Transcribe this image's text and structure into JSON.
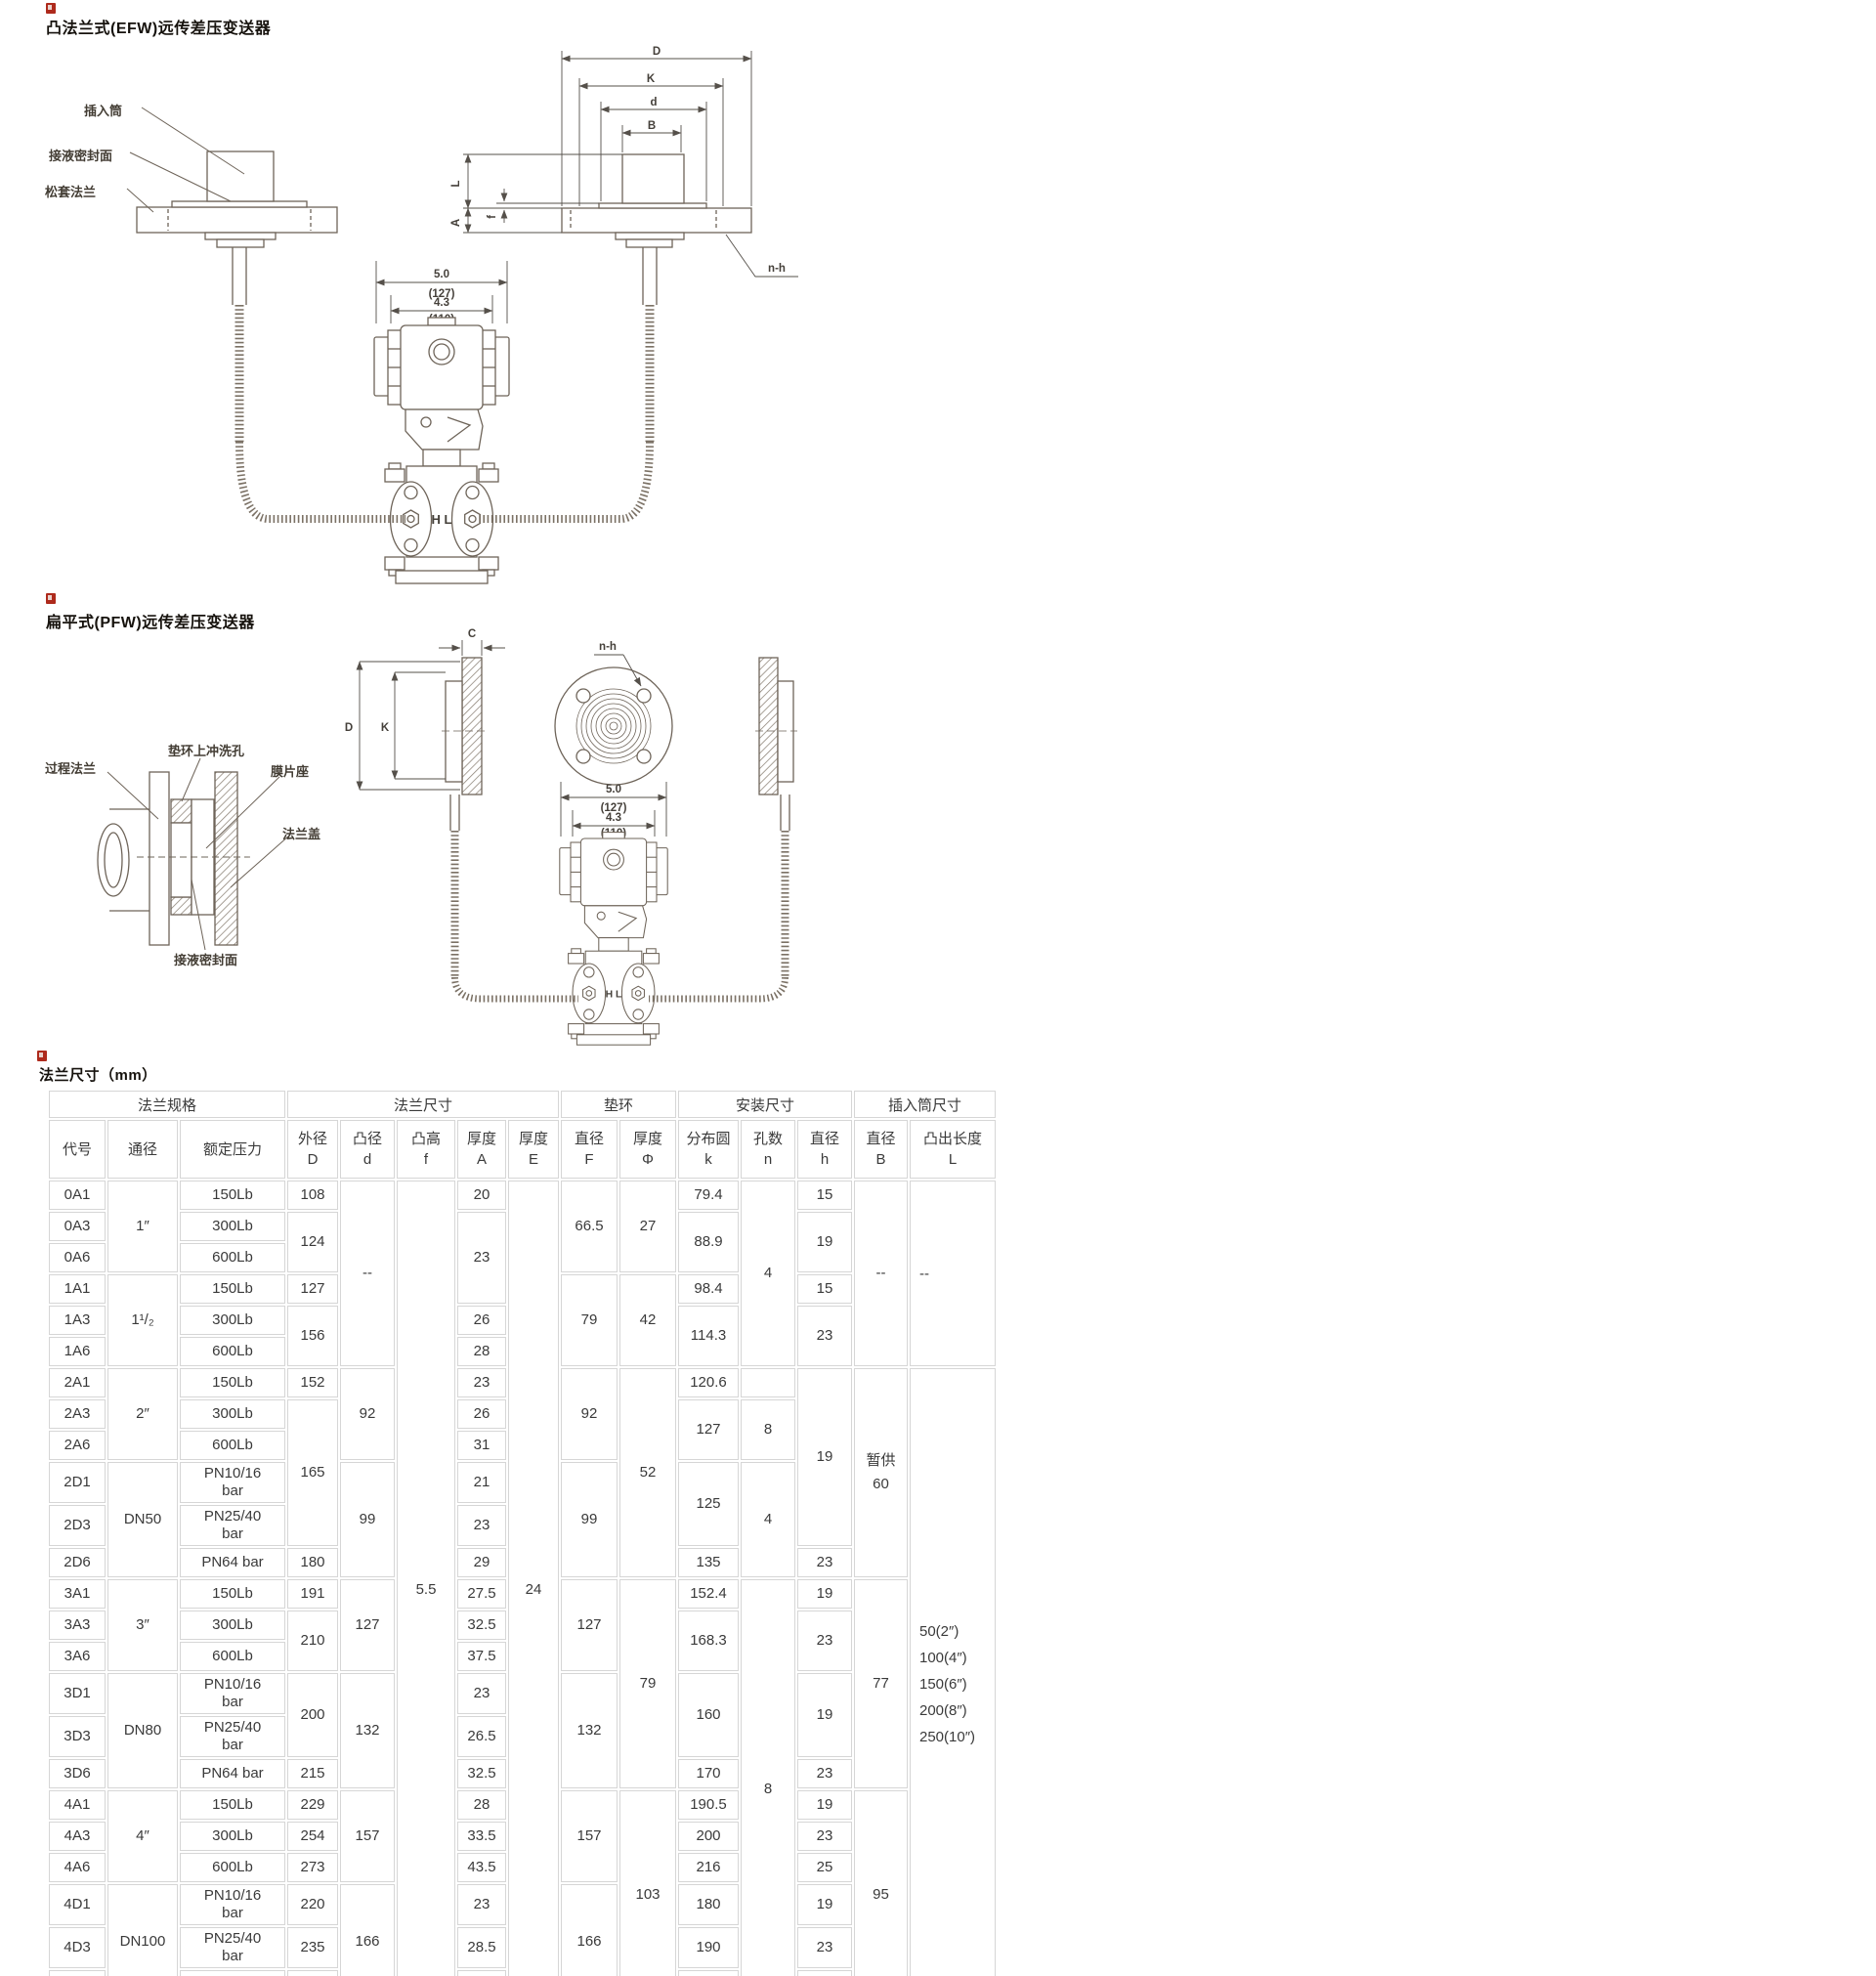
{
  "d1": {
    "title": "凸法兰式(EFW)远传差压变送器",
    "labels": {
      "insert": "插入筒",
      "seal": "接液密封面",
      "loose": "松套法兰"
    },
    "dims": {
      "D": "D",
      "K": "K",
      "d": "d",
      "B": "B",
      "L": "L",
      "A": "A",
      "f": "f",
      "nh": "n-h"
    },
    "body": {
      "w1": "5.0",
      "w1mm": "(127)",
      "w2": "4.3",
      "w2mm": "(110)"
    }
  },
  "d2": {
    "title": "扁平式(PFW)远传差压变送器",
    "labels": {
      "process": "过程法兰",
      "flush": "垫环上冲洗孔",
      "seat": "膜片座",
      "cover": "法兰盖",
      "seal": "接液密封面"
    },
    "dims": {
      "C": "C",
      "D": "D",
      "K": "K",
      "nh": "n-h"
    },
    "body": {
      "w1": "5.0",
      "w1mm": "(127)",
      "w2": "4.3",
      "w2mm": "(110)"
    }
  },
  "shared": {
    "hl": "H L"
  },
  "table": {
    "title": "法兰尺寸（mm）",
    "groups": [
      {
        "label": "法兰规格",
        "span": 3
      },
      {
        "label": "法兰尺寸",
        "span": 5
      },
      {
        "label": "垫环",
        "span": 2
      },
      {
        "label": "安装尺寸",
        "span": 3
      },
      {
        "label": "插入筒尺寸",
        "span": 2
      }
    ],
    "columns": [
      "代号",
      "通径",
      "额定压力",
      "外径\nD",
      "凸径\nd",
      "凸高\nf",
      "厚度\nA",
      "厚度\nE",
      "直径\nF",
      "厚度\nΦ",
      "分布圆\nk",
      "孔数\nn",
      "直径\nh",
      "直径\nB",
      "凸出长度\nL"
    ],
    "rows": [
      [
        [
          0,
          "0A1"
        ],
        [
          1,
          "1″",
          3
        ],
        [
          2,
          "150Lb"
        ],
        [
          3,
          "108"
        ],
        [
          4,
          "--",
          6
        ],
        [
          5,
          "5.5",
          24
        ],
        [
          6,
          "20"
        ],
        [
          7,
          "24",
          24
        ],
        [
          8,
          "66.5",
          3
        ],
        [
          9,
          "27",
          3
        ],
        [
          10,
          "79.4"
        ],
        [
          11,
          "4",
          6
        ],
        [
          12,
          "15"
        ],
        [
          13,
          "--",
          6
        ],
        [
          14,
          "--",
          6
        ]
      ],
      [
        [
          0,
          "0A3"
        ],
        [
          2,
          "300Lb"
        ],
        [
          3,
          "124",
          2
        ],
        [
          6,
          "23",
          3
        ],
        [
          10,
          "88.9",
          2
        ],
        [
          12,
          "19",
          2
        ]
      ],
      [
        [
          0,
          "0A6"
        ],
        [
          2,
          "600Lb"
        ]
      ],
      [
        [
          0,
          "1A1"
        ],
        [
          1,
          "1¹/₂",
          3
        ],
        [
          2,
          "150Lb"
        ],
        [
          3,
          "127"
        ],
        [
          8,
          "79",
          3
        ],
        [
          9,
          "42",
          3
        ],
        [
          10,
          "98.4"
        ],
        [
          12,
          "15"
        ]
      ],
      [
        [
          0,
          "1A3"
        ],
        [
          2,
          "300Lb"
        ],
        [
          3,
          "156",
          2
        ],
        [
          6,
          "26"
        ],
        [
          10,
          "114.3",
          2
        ],
        [
          12,
          "23",
          2
        ]
      ],
      [
        [
          0,
          "1A6"
        ],
        [
          2,
          "600Lb"
        ],
        [
          6,
          "28"
        ]
      ],
      [
        [
          0,
          "2A1"
        ],
        [
          1,
          "2″",
          3
        ],
        [
          2,
          "150Lb"
        ],
        [
          3,
          "152"
        ],
        [
          4,
          "92",
          3
        ],
        [
          6,
          "23"
        ],
        [
          8,
          "92",
          3
        ],
        [
          9,
          "52",
          6
        ],
        [
          10,
          "120.6"
        ],
        [
          11,
          ""
        ],
        [
          12,
          "19",
          5
        ],
        [
          13,
          "暂供\n60",
          6
        ],
        [
          14,
          "50(2″)\n100(4″)\n150(6″)\n200(8″)\n250(10″)",
          18
        ]
      ],
      [
        [
          0,
          "2A3"
        ],
        [
          2,
          "300Lb"
        ],
        [
          3,
          "165",
          4
        ],
        [
          6,
          "26"
        ],
        [
          10,
          "127",
          2
        ],
        [
          11,
          "8",
          2
        ]
      ],
      [
        [
          0,
          "2A6"
        ],
        [
          2,
          "600Lb"
        ],
        [
          6,
          "31"
        ]
      ],
      [
        [
          0,
          "2D1"
        ],
        [
          1,
          "DN50",
          3
        ],
        [
          2,
          "PN10/16\nbar"
        ],
        [
          4,
          "99",
          3
        ],
        [
          6,
          "21"
        ],
        [
          8,
          "99",
          3
        ],
        [
          10,
          "125",
          2
        ],
        [
          11,
          "4",
          3
        ]
      ],
      [
        [
          0,
          "2D3"
        ],
        [
          2,
          "PN25/40\nbar"
        ],
        [
          6,
          "23"
        ]
      ],
      [
        [
          0,
          "2D6"
        ],
        [
          2,
          "PN64 bar"
        ],
        [
          3,
          "180"
        ],
        [
          6,
          "29"
        ],
        [
          10,
          "135"
        ],
        [
          12,
          "23"
        ]
      ],
      [
        [
          0,
          "3A1"
        ],
        [
          1,
          "3″",
          3
        ],
        [
          2,
          "150Lb"
        ],
        [
          3,
          "191"
        ],
        [
          4,
          "127",
          3
        ],
        [
          6,
          "27.5"
        ],
        [
          8,
          "127",
          3
        ],
        [
          9,
          "79",
          6
        ],
        [
          10,
          "152.4"
        ],
        [
          11,
          "8",
          12
        ],
        [
          12,
          "19"
        ],
        [
          13,
          "77",
          6
        ]
      ],
      [
        [
          0,
          "3A3"
        ],
        [
          2,
          "300Lb"
        ],
        [
          3,
          "210",
          2
        ],
        [
          6,
          "32.5"
        ],
        [
          10,
          "168.3",
          2
        ],
        [
          12,
          "23",
          2
        ]
      ],
      [
        [
          0,
          "3A6"
        ],
        [
          2,
          "600Lb"
        ],
        [
          6,
          "37.5"
        ]
      ],
      [
        [
          0,
          "3D1"
        ],
        [
          1,
          "DN80",
          3
        ],
        [
          2,
          "PN10/16\nbar"
        ],
        [
          3,
          "200",
          2
        ],
        [
          4,
          "132",
          3
        ],
        [
          6,
          "23"
        ],
        [
          8,
          "132",
          3
        ],
        [
          10,
          "160",
          2
        ],
        [
          12,
          "19",
          2
        ]
      ],
      [
        [
          0,
          "3D3"
        ],
        [
          2,
          "PN25/40\nbar"
        ],
        [
          6,
          "26.5"
        ]
      ],
      [
        [
          0,
          "3D6"
        ],
        [
          2,
          "PN64 bar"
        ],
        [
          3,
          "215"
        ],
        [
          6,
          "32.5"
        ],
        [
          10,
          "170"
        ],
        [
          12,
          "23"
        ]
      ],
      [
        [
          0,
          "4A1"
        ],
        [
          1,
          "4″",
          3
        ],
        [
          2,
          "150Lb"
        ],
        [
          3,
          "229"
        ],
        [
          4,
          "157",
          3
        ],
        [
          6,
          "28"
        ],
        [
          8,
          "157",
          3
        ],
        [
          9,
          "103",
          6
        ],
        [
          10,
          "190.5"
        ],
        [
          12,
          "19"
        ],
        [
          13,
          "95",
          6
        ]
      ],
      [
        [
          0,
          "4A3"
        ],
        [
          2,
          "300Lb"
        ],
        [
          3,
          "254"
        ],
        [
          6,
          "33.5"
        ],
        [
          10,
          "200"
        ],
        [
          12,
          "23"
        ]
      ],
      [
        [
          0,
          "4A6"
        ],
        [
          2,
          "600Lb"
        ],
        [
          3,
          "273"
        ],
        [
          6,
          "43.5"
        ],
        [
          10,
          "216"
        ],
        [
          12,
          "25"
        ]
      ],
      [
        [
          0,
          "4D1"
        ],
        [
          1,
          "DN100",
          3
        ],
        [
          2,
          "PN10/16\nbar"
        ],
        [
          3,
          "220"
        ],
        [
          4,
          "166",
          3
        ],
        [
          6,
          "23"
        ],
        [
          8,
          "166",
          3
        ],
        [
          10,
          "180"
        ],
        [
          12,
          "19"
        ]
      ],
      [
        [
          0,
          "4D3"
        ],
        [
          2,
          "PN25/40\nbar"
        ],
        [
          3,
          "235"
        ],
        [
          6,
          "28.5"
        ],
        [
          10,
          "190"
        ],
        [
          12,
          "23"
        ]
      ],
      [
        [
          0,
          "4D6"
        ],
        [
          2,
          "PN64 bar"
        ],
        [
          3,
          "250"
        ],
        [
          6,
          "34.5"
        ],
        [
          10,
          "200"
        ],
        [
          12,
          "27"
        ]
      ]
    ]
  }
}
